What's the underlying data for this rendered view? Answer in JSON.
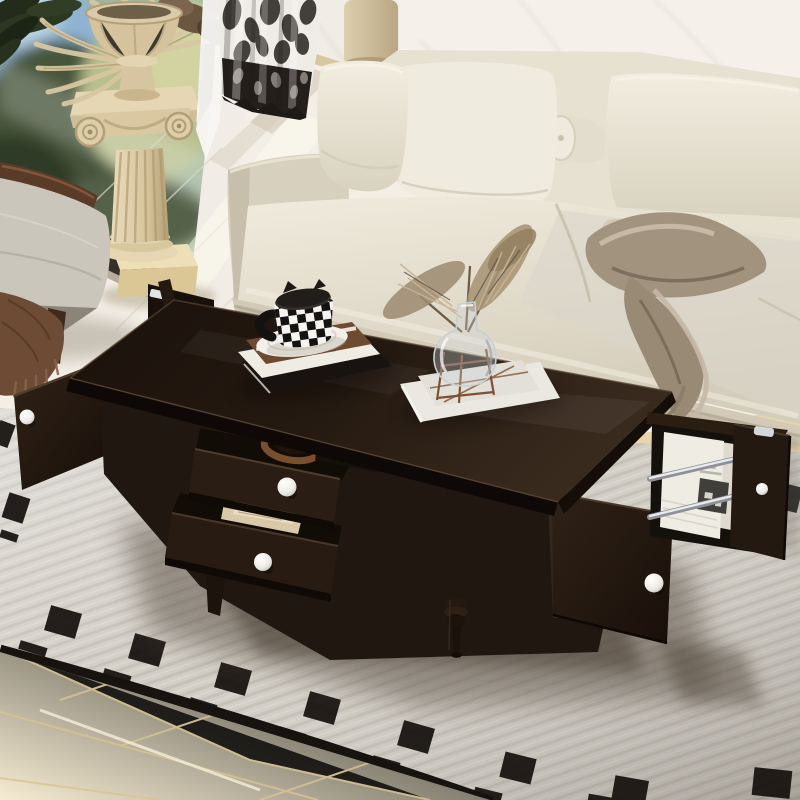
{
  "meta": {
    "type": "photograph",
    "subject": "Espresso brown coffee table with two open drawers and open end storage doors, styled in a bright living room",
    "visible_text": "none"
  },
  "scene": {
    "room": "living room",
    "objects": [
      {
        "id": "window",
        "label": "window with blurred garden view"
      },
      {
        "id": "plant-leaves",
        "label": "dark houseplant leaves"
      },
      {
        "id": "curtain",
        "label": "black and white toile curtain"
      },
      {
        "id": "sheer-curtain",
        "label": "white sheer curtain"
      },
      {
        "id": "marble-wall",
        "label": "white marble wall"
      },
      {
        "id": "pedestal-column",
        "label": "ionic column pedestal on plinth"
      },
      {
        "id": "urn-planter",
        "label": "carved urn with dried palm fronds"
      },
      {
        "id": "armchair",
        "label": "gray armchair with wood frame and brown fringed throw"
      },
      {
        "id": "sofa",
        "label": "cream fabric sofa with back cushions and bolster pillow"
      },
      {
        "id": "throw-blanket",
        "label": "taupe satin throw blanket draped over seat"
      },
      {
        "id": "coffee-table",
        "label": "dark espresso rectangular coffee table"
      },
      {
        "id": "drawer-upper",
        "label": "open upper drawer holding a leather belt and accessories"
      },
      {
        "id": "drawer-lower",
        "label": "open lower drawer holding papers and envelopes"
      },
      {
        "id": "left-end-door",
        "label": "open left end door with round white knob"
      },
      {
        "id": "front-right-door",
        "label": "front right door with round white knob"
      },
      {
        "id": "side-compartment",
        "label": "open end compartment with magazines behind two chrome rails"
      },
      {
        "id": "right-end-door",
        "label": "open right end door panel with round white knob"
      },
      {
        "id": "book-stack",
        "label": "stack of three books on tabletop"
      },
      {
        "id": "checkered-mug",
        "label": "black and white checkered mug with cat-ear lid on white saucer"
      },
      {
        "id": "glass-vase",
        "label": "clear glass vase with pampas grass on white books"
      },
      {
        "id": "turned-leg",
        "label": "dark turned wood leg"
      },
      {
        "id": "area-rug",
        "label": "ivory woven rug with black squares and dashes border"
      },
      {
        "id": "wood-floor",
        "label": "light wood plank floor"
      }
    ],
    "counts": {
      "white_knobs": 4,
      "open_drawers": 2,
      "chrome_rails": 2,
      "back_cushions": 3,
      "bolster_pillows": 1
    }
  },
  "palette": {
    "wall": "#f1ede6",
    "wallVein": "#ddd6cb",
    "windowFrame": "#3a342e",
    "sky": "#8fb3d2",
    "foliageDark": "#46543a",
    "foliageLight": "#b9bf8e",
    "leaves": "#242d1c",
    "curtainLight": "#efece6",
    "curtainDark": "#211e1b",
    "sheer": "#f8f7f3",
    "column": "#e5d6b4",
    "columnShade": "#b3a078",
    "plinth": "#eee0b6",
    "floor": "#f3efe7",
    "floorSeam": "#ddd6c9",
    "wood": "#f0e0bd",
    "woodDeep": "#e2cba0",
    "rug": "#d8d4cb",
    "rugDark": "#b2aba0",
    "rugBlack": "#17130f",
    "sofa": "#ece6d8",
    "sofaShade": "#cfc7b4",
    "seatCool": "#dcd9cd",
    "blanket": "#a2937f",
    "blanketShade": "#746555",
    "chairFabric": "#cac6bb",
    "chairWood": "#5a3b27",
    "fringedThrow": "#6d4b35",
    "table": "#241a12",
    "tableDeep": "#140d08",
    "tableEdge": "#5b4733",
    "knob": "#f0eeea",
    "chrome": "#c9cdd0",
    "paper": "#efece4",
    "bookRust": "#6e4a31",
    "pampas": "#a08a6d",
    "glassTint": "#cdd6da",
    "bronze": "#8a5c38",
    "shadow": "#55483c"
  }
}
